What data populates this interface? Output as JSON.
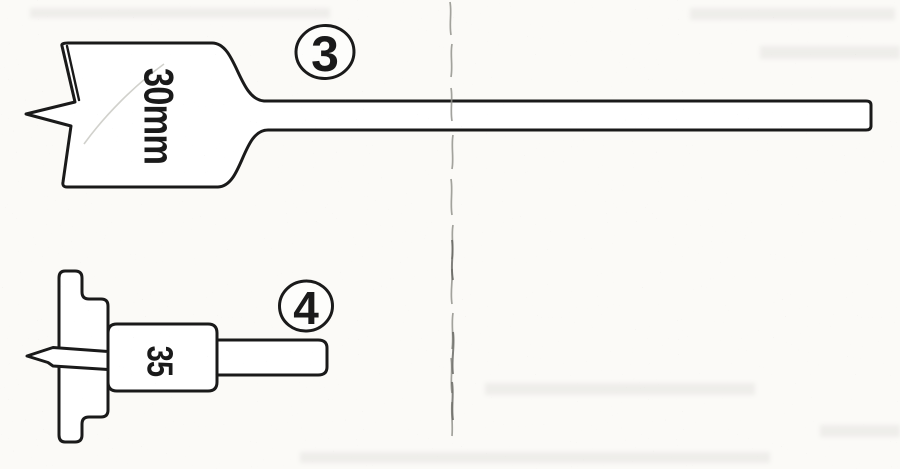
{
  "figure": {
    "items": [
      {
        "badge": "3",
        "size_label": "30mm",
        "drawing": "spade-drill-bit"
      },
      {
        "badge": "4",
        "size_label": "35",
        "drawing": "forstner-drill-bit"
      }
    ],
    "colors": {
      "ink": "#1a1a1a",
      "paper": "#fbfaf7"
    }
  }
}
